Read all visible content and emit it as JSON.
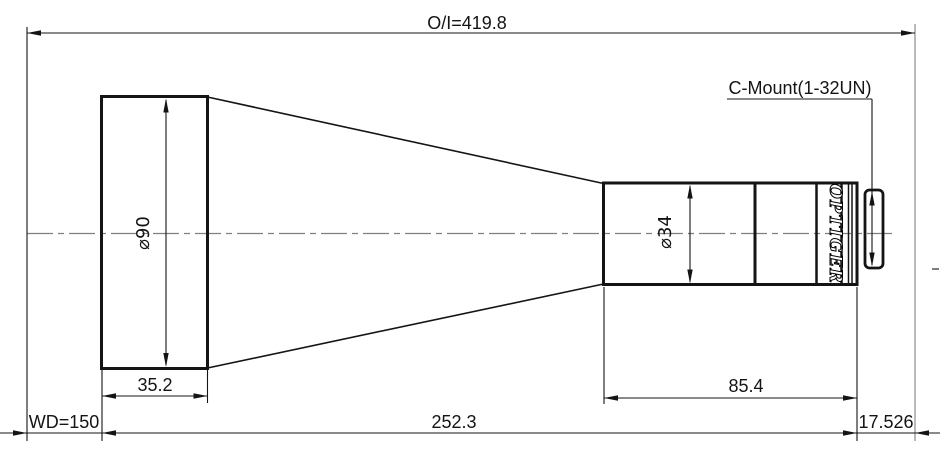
{
  "drawing": {
    "brand": "OPTIGER",
    "mount": {
      "label": "C-Mount(1-32UN)"
    },
    "dims": {
      "oi": "O/I=419.8",
      "wd": "WD=150",
      "front_diameter": "⌀90",
      "rear_diameter": "⌀34",
      "front_length": "35.2",
      "rear_length": "85.4",
      "mid_length": "252.3",
      "flange_focal": "17.526"
    },
    "colors": {
      "line": "#141414",
      "centerline": "#7f7f7f",
      "extension_gray": "#8c8c8c",
      "background": "#ffffff"
    }
  }
}
